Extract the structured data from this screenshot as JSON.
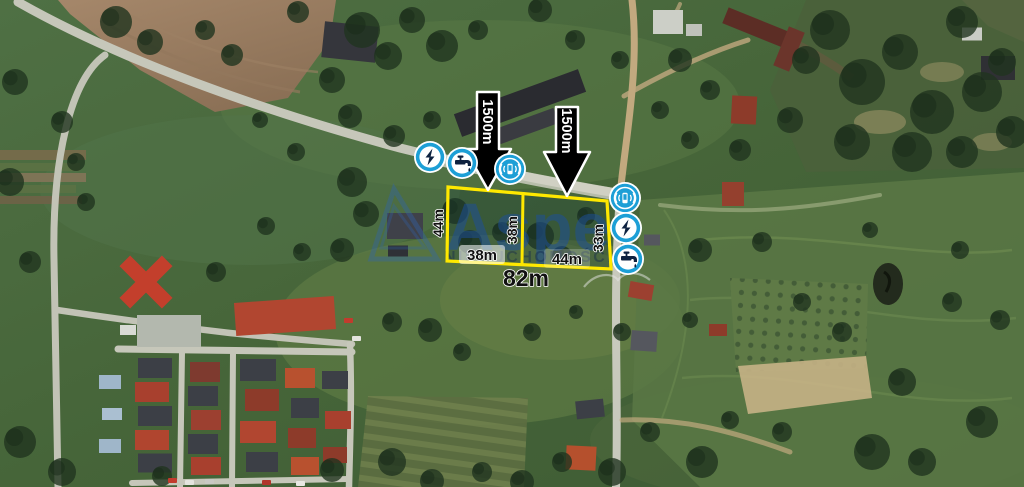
{
  "listing_map": {
    "description": "satellite aerial photo of building plots with real-estate annotations",
    "watermark": {
      "brand": "Aspe",
      "subtext": "NIERUCHOMOŚCI",
      "brand_color": "#1c4fa0"
    },
    "plot": {
      "outline_color": "#ffe800",
      "side_left": "44m",
      "divider": "38m",
      "side_right": "33m",
      "frontage_left": "38m",
      "frontage_right": "44m",
      "total_frontage": "82m"
    },
    "distance_arrows": {
      "arrow1": "1500m",
      "arrow2": "1500m"
    },
    "utilities": {
      "accent_color": "#1d9fd6",
      "left_group": [
        {
          "id": "electricity",
          "glyph": "lightning-bolt"
        },
        {
          "id": "water",
          "glyph": "faucet-with-drop"
        },
        {
          "id": "gsm",
          "glyph": "phone-with-signal-waves"
        }
      ],
      "right_group": [
        {
          "id": "gsm",
          "glyph": "phone-with-signal-waves"
        },
        {
          "id": "electricity",
          "glyph": "lightning-bolt"
        },
        {
          "id": "water",
          "glyph": "faucet-with-drop"
        }
      ]
    }
  }
}
